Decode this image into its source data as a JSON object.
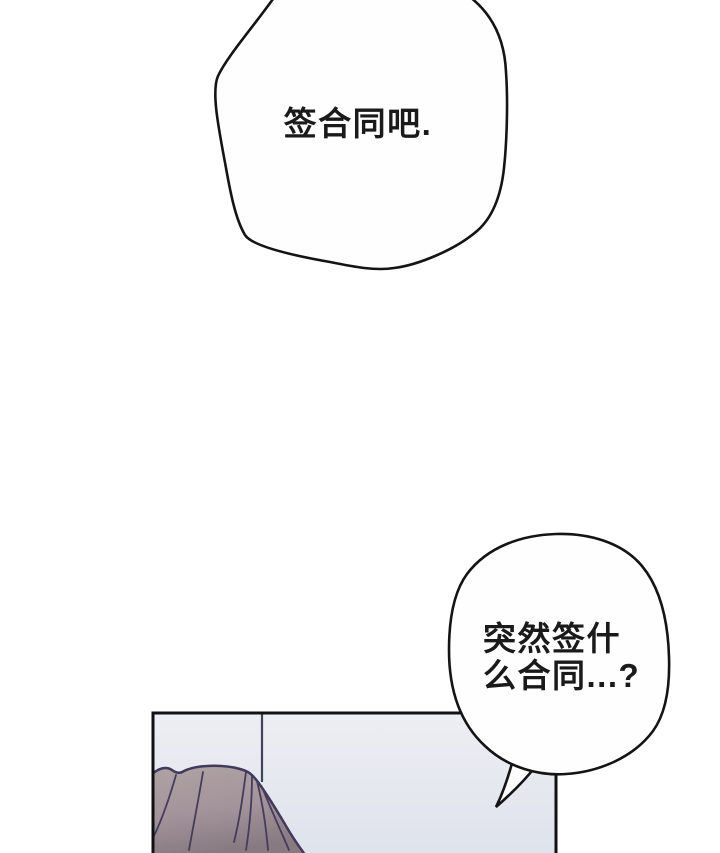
{
  "meta": {
    "type": "comic-page",
    "language": "zh"
  },
  "colors": {
    "page_bg": "#ffffff",
    "ink": "#141414",
    "text": "#1a1a1a",
    "bubble_fill": "#fefefe",
    "panel_bg_top": "#eceef3",
    "panel_bg_bottom": "#dee2eb",
    "panel_border": "#111111",
    "wall_line": "#3f4459",
    "hair_top": "#b0a3a4",
    "hair_mid": "#a2949a",
    "hair_bottom": "#887a81",
    "hair_outline": "#43395b",
    "hair_strand": "#453c5e"
  },
  "dialogue": {
    "bubble_top": {
      "text": "签合同吧."
    },
    "bubble_bottom": {
      "line1": "突然签什",
      "line2": "么合同...?"
    }
  }
}
